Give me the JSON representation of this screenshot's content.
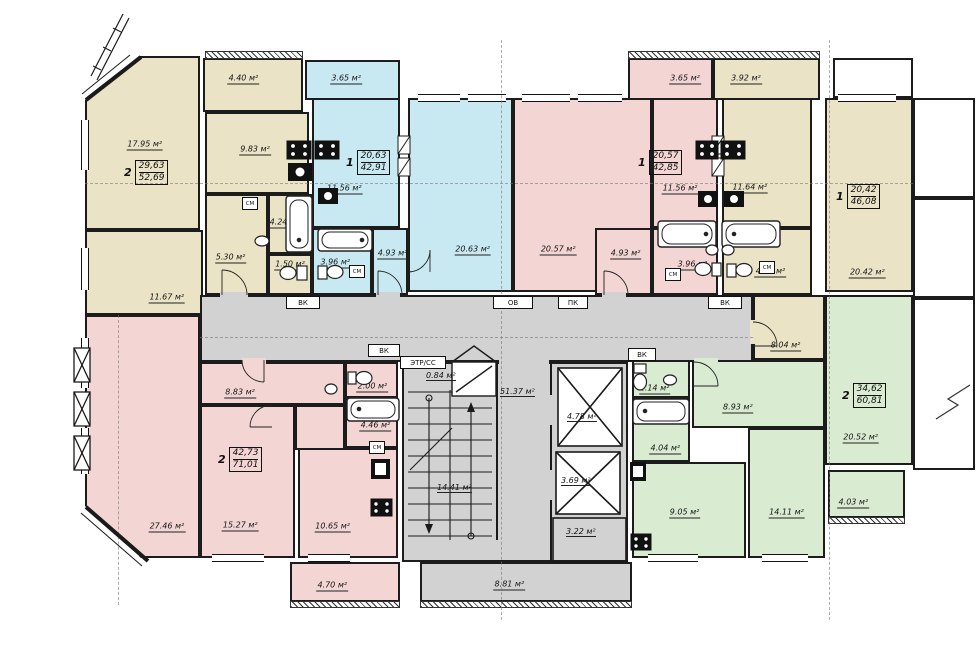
{
  "unit": "м²",
  "colors": {
    "beige": "#EBE3C6",
    "blue": "#C8E9F2",
    "pink": "#F3D5D3",
    "green": "#D9ECD2",
    "gray": "#D2D2D2",
    "wall": "#1A1A1A"
  },
  "apartments": [
    {
      "rooms_count": "2",
      "living": "29,63",
      "total": "52,69"
    },
    {
      "rooms_count": "1",
      "living": "20,63",
      "total": "42,91"
    },
    {
      "rooms_count": "1",
      "living": "20,57",
      "total": "42,85"
    },
    {
      "rooms_count": "1",
      "living": "20,42",
      "total": "46,08"
    },
    {
      "rooms_count": "2",
      "living": "34,62",
      "total": "60,81"
    },
    {
      "rooms_count": "2",
      "living": "42,73",
      "total": "71,01"
    }
  ],
  "rooms": {
    "a_living": "17.95 м²",
    "a_room2": "11.67 м²",
    "a_kitchen": "9.83 м²",
    "a_hall": "5.30 м²",
    "a_bath": "4.24 м²",
    "a_wc": "1.50 м²",
    "a_balcony": "4.40 м²",
    "b_balcony": "3.65 м²",
    "b_kitchen": "11.56 м²",
    "b_living": "20.63 м²",
    "b_hall": "4.93 м²",
    "b_bath": "3.96 м²",
    "c_balcony": "3.65 м²",
    "c_living": "20.57 м²",
    "c_kitchen": "11.56 м²",
    "c_hall": "4.93 м²",
    "c_bath": "3.96 м²",
    "d_balcony": "3.92 м²",
    "d_kitchen": "11.64 м²",
    "d_living": "20.42 м²",
    "d_bath": "4.03 м²",
    "d_hall": "8.04 м²",
    "e_living": "20.52 м²",
    "e_hall": "8.93 м²",
    "e_wc": "2.14 м²",
    "e_bath": "4.04 м²",
    "e_kitchen": "9.05 м²",
    "e_bedroom": "14.11 м²",
    "e_balcony": "4.03 м²",
    "f_living": "27.46 м²",
    "f_bedroom": "15.27 м²",
    "f_kitchen": "10.65 м²",
    "f_hall": "8.83 м²",
    "f_bath": "4.46 м²",
    "f_wc": "2.00 м²",
    "f_balcony": "4.70 м²",
    "core_corridor": "51.37 м²",
    "core_stairs": "14.41 м²",
    "core_lift1": "4.78 м²",
    "core_lift2": "3.69 м²",
    "core_shaft": "3.22 м²",
    "core_closet": "0.84 м²",
    "core_balcony": "8.81 м²"
  },
  "service": {
    "vk": "ВК",
    "ov": "ОВ",
    "pk": "ПК",
    "etr": "ЭТР/СС",
    "sm": "СМ"
  }
}
